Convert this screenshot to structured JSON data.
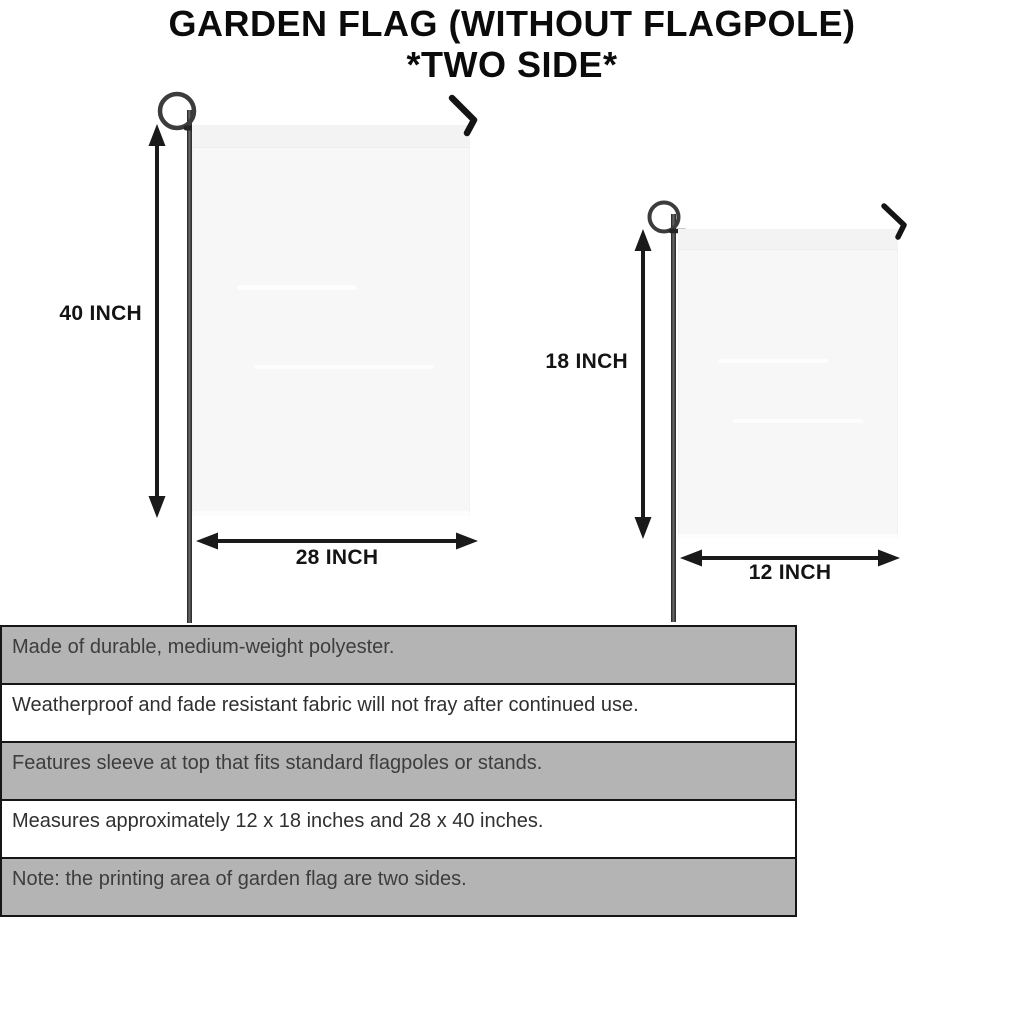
{
  "title": {
    "line1": "GARDEN FLAG (WITHOUT FLAGPOLE)",
    "line2": "*TWO SIDE*"
  },
  "diagram": {
    "large_flag": {
      "height_label": "40 INCH",
      "width_label": "28 INCH"
    },
    "small_flag": {
      "height_label": "18 INCH",
      "width_label": "12 INCH"
    }
  },
  "features": [
    "Made of durable, medium-weight polyester.",
    "Weatherproof and fade resistant fabric will not fray after continued use.",
    "Features sleeve at top that fits standard flagpoles or stands.",
    "Measures approximately 12 x 18 inches and 28 x 40 inches.",
    "Note: the printing area of garden flag are two sides."
  ],
  "colors": {
    "table_row_gray": "#b4b4b4",
    "table_border": "#161616",
    "flag_fill": "#f7f7f7",
    "pole": "#2a2a2a",
    "arrow": "#1a1a1a",
    "title_text": "#0b0b0b",
    "feature_text": "#3d3d3d"
  }
}
